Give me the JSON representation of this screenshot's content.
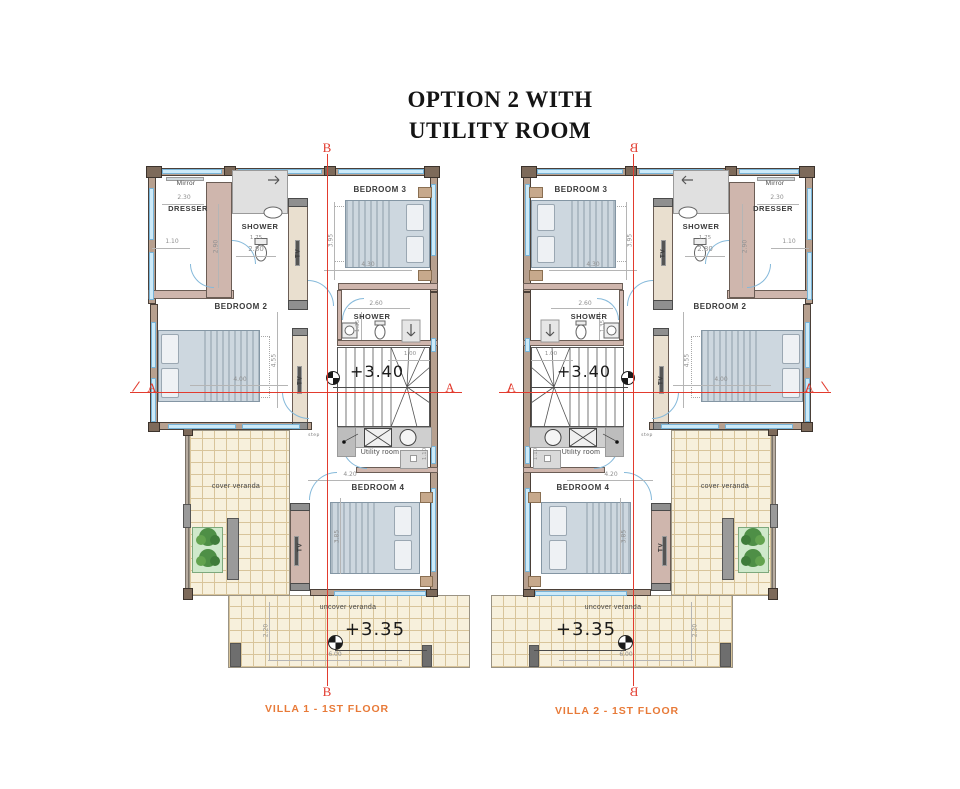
{
  "title": {
    "line1": "OPTION 2 WITH",
    "line2": "UTILITY ROOM"
  },
  "captions": {
    "villa1": "VILLA 1 - 1ST FLOOR",
    "villa2": "VILLA 2 - 1ST FLOOR"
  },
  "sections": {
    "a": "A",
    "b": "B"
  },
  "villa": {
    "rooms": {
      "bedroom2": "BEDROOM 2",
      "bedroom3": "BEDROOM 3",
      "bedroom4": "BEDROOM 4",
      "shower_top": "SHOWER",
      "shower_mid": "SHOWER",
      "utility": "Utility room",
      "dresser": "DRESSER",
      "mirror": "Mirror",
      "tv": "TV",
      "cover_veranda": "cover veranda",
      "uncover_veranda": "uncover veranda",
      "step_note": "step"
    },
    "levels": {
      "stair_level": "+3.40",
      "veranda_level": "+3.35"
    },
    "dims": {
      "d230": "2.30",
      "d290": "2.90",
      "d110": "1.10",
      "d175": "1.75",
      "d280": "2.80",
      "d430": "4.30",
      "d395": "3.95",
      "d455": "4.55",
      "d400": "4.00",
      "d260": "2.60",
      "d135": "1.35",
      "d100": "1.00",
      "d420": "4.20",
      "d385": "3.85",
      "d220": "2.20",
      "d600": "6.00",
      "d110u": "1.10"
    }
  },
  "colors": {
    "section_red": "#e23b2e",
    "caption_orange": "#e87a38",
    "wall_tan": "#b7a08f",
    "wall_pink": "#cfb6ad",
    "window_blue": "#cdeaf8",
    "tile_cream": "#f7f0dc",
    "planter_green": "#cfe9cb"
  }
}
